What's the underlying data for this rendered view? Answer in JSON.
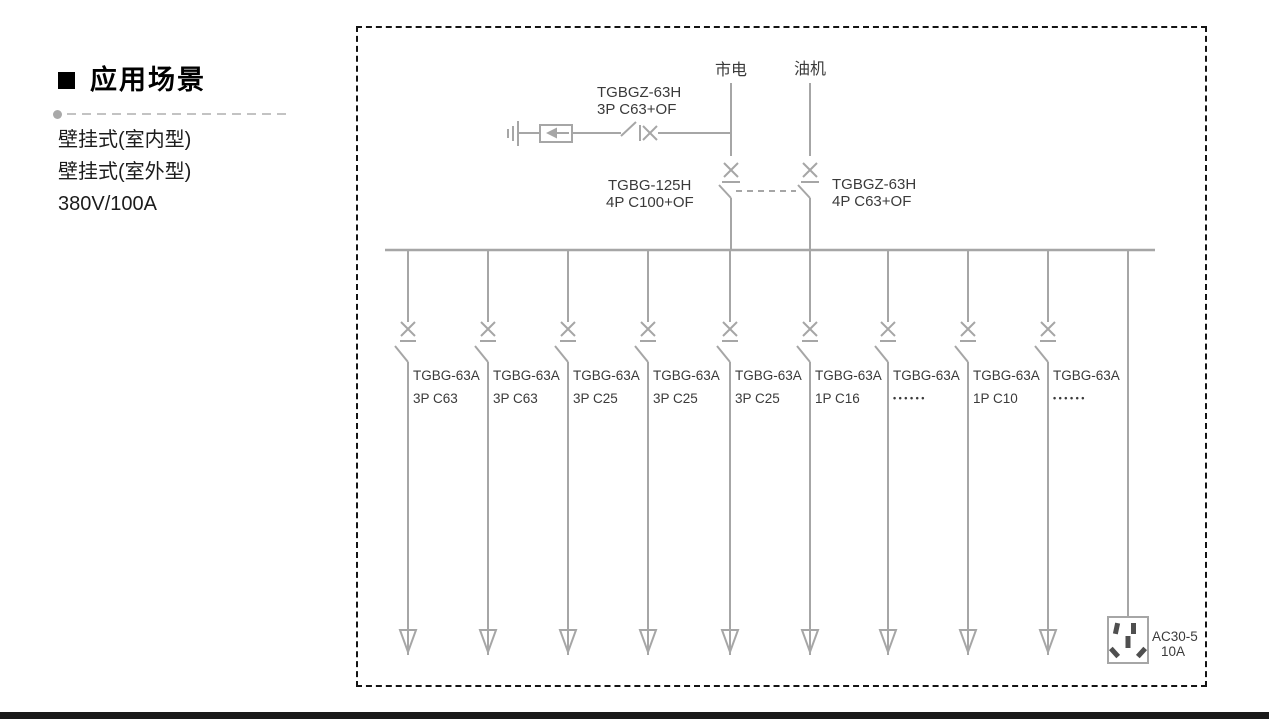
{
  "sidebar": {
    "heading": "应用场景",
    "items": [
      {
        "label": "壁挂式(室内型)"
      },
      {
        "label": "壁挂式(室外型)"
      },
      {
        "label": "380V/100A"
      }
    ]
  },
  "diagram": {
    "sources": [
      {
        "label": "市电"
      },
      {
        "label": "油机"
      }
    ],
    "spd_breaker": {
      "model": "TGBGZ-63H",
      "rating": "3P C63+OF"
    },
    "mains_breaker": {
      "model": "TGBG-125H",
      "rating": "4P C100+OF"
    },
    "gen_breaker": {
      "model": "TGBGZ-63H",
      "rating": "4P C63+OF"
    },
    "branches": [
      {
        "model": "TGBG-63A",
        "rating": "3P C63"
      },
      {
        "model": "TGBG-63A",
        "rating": "3P C63"
      },
      {
        "model": "TGBG-63A",
        "rating": "3P C25"
      },
      {
        "model": "TGBG-63A",
        "rating": "3P C25"
      },
      {
        "model": "TGBG-63A",
        "rating": "3P C25"
      },
      {
        "model": "TGBG-63A",
        "rating": "1P C16"
      },
      {
        "model": "TGBG-63A",
        "rating": "••••••"
      },
      {
        "model": "TGBG-63A",
        "rating": "1P C10"
      },
      {
        "model": "TGBG-63A",
        "rating": "••••••"
      }
    ],
    "socket": {
      "model": "AC30-5",
      "rating": "10A"
    },
    "colors": {
      "line": "#a6a6a6",
      "label": "#3a3a3a",
      "border": "#141414"
    }
  }
}
